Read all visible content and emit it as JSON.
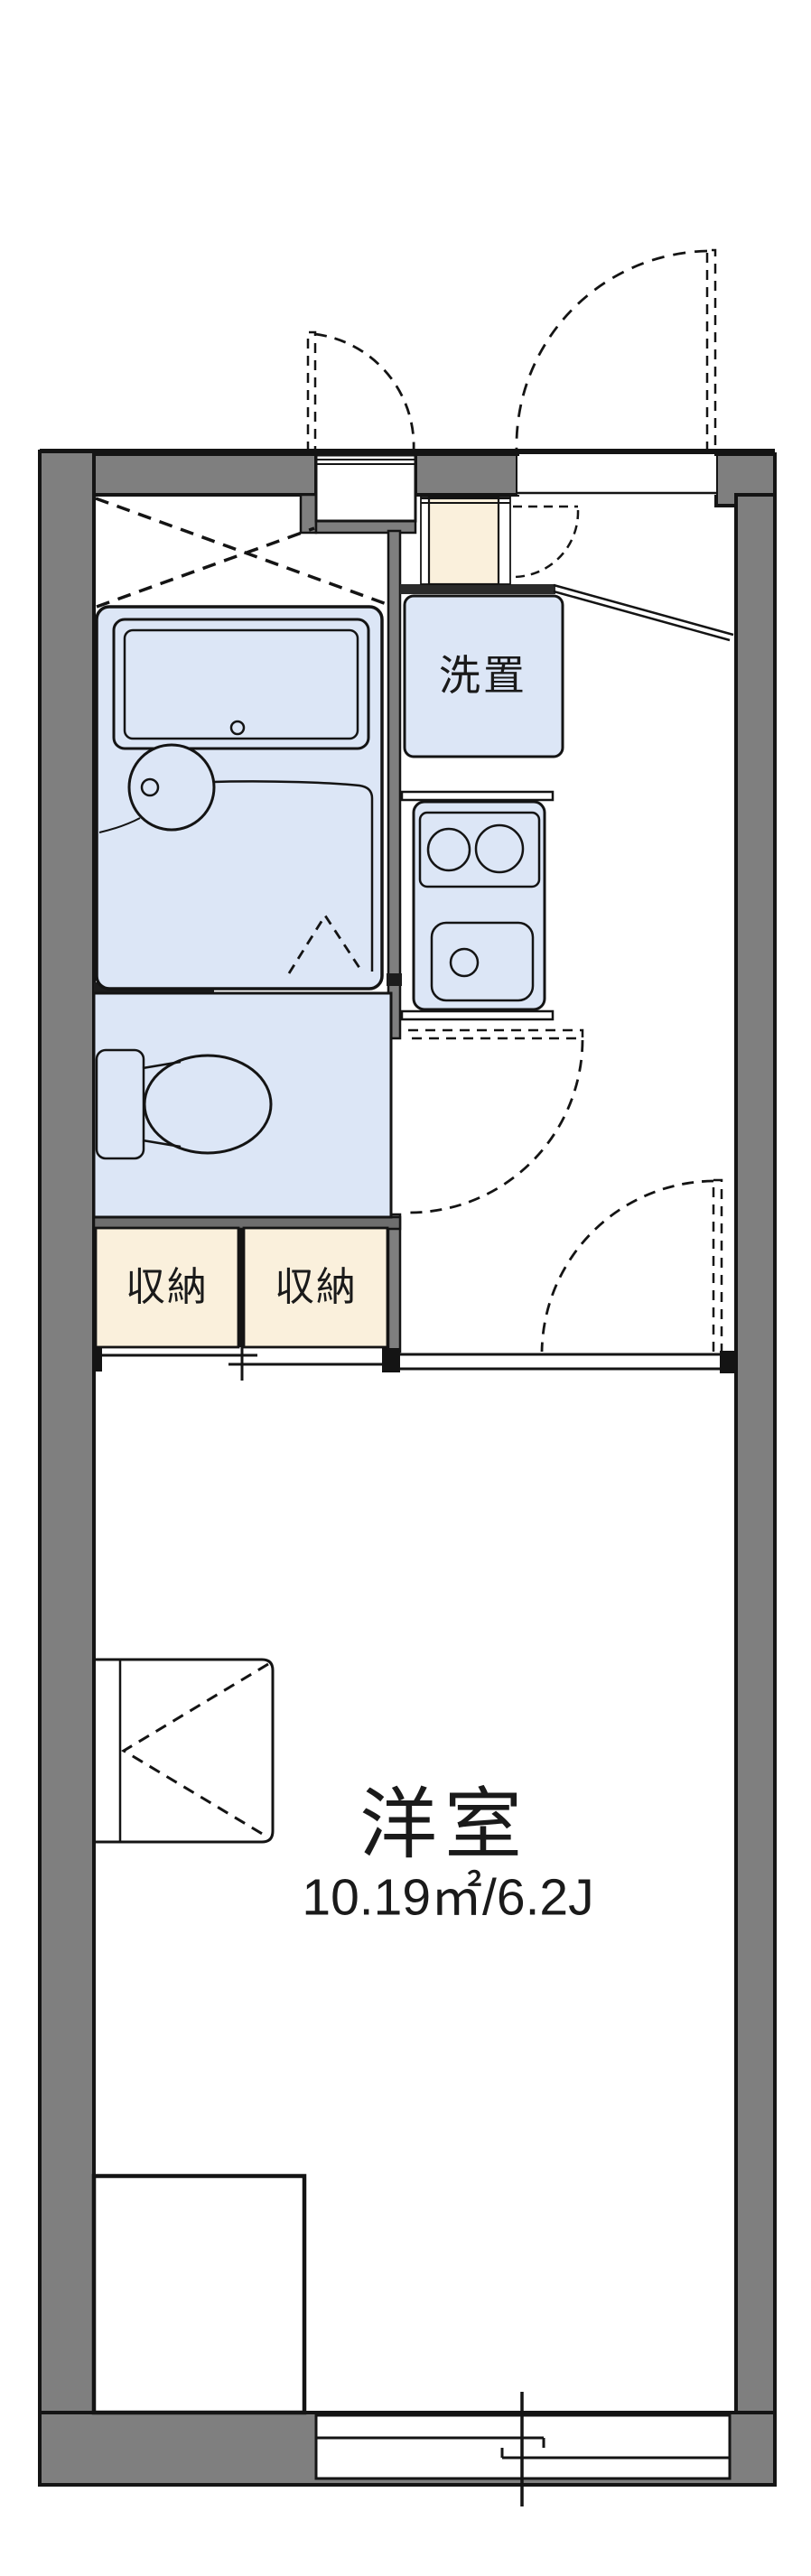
{
  "floorplan": {
    "rooms": {
      "laundry": {
        "label": "洗置"
      },
      "storage_left": {
        "label": "収納"
      },
      "storage_right": {
        "label": "収納"
      },
      "main_room": {
        "label": "洋室",
        "area": "10.19㎡/6.2J"
      }
    },
    "colors": {
      "wall": "#7f7f7f",
      "line": "#141414",
      "room_blue": "#dce6f6",
      "cream": "#faf0dc",
      "paper": "#ffffff",
      "text": "#1a1a1a"
    }
  }
}
